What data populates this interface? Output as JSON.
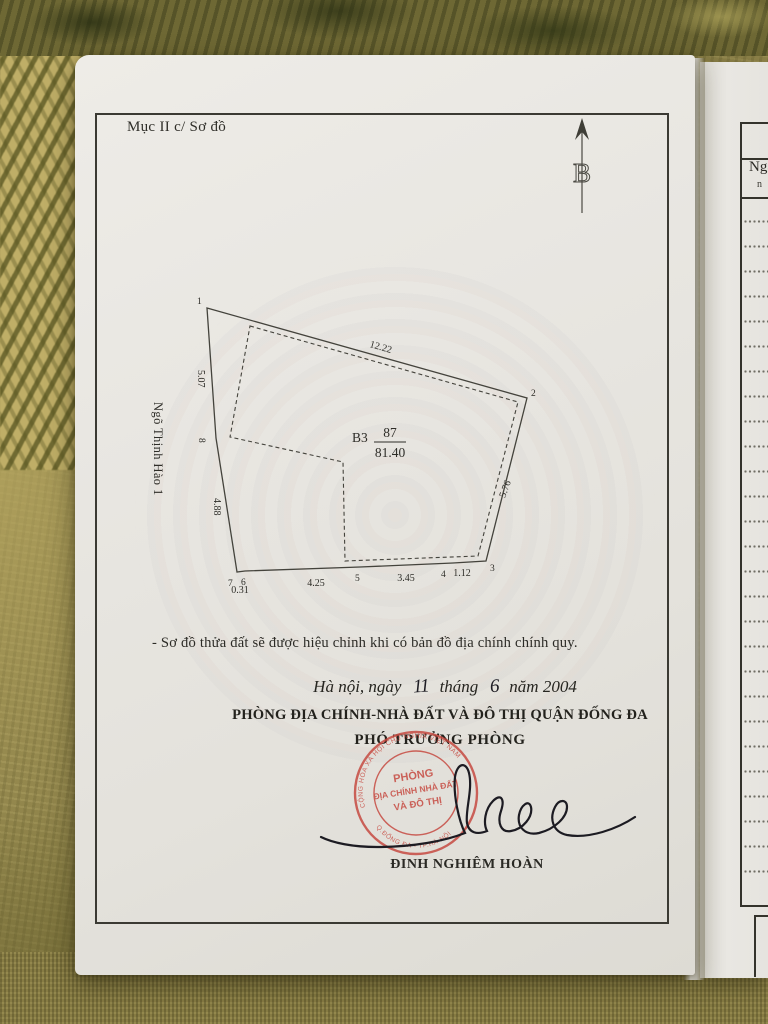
{
  "document": {
    "section_label": "Mục II c/ Sơ đồ",
    "compass_letter": "B",
    "note": "- Sơ đồ thửa đất sẽ được hiệu chỉnh khi có bản đồ địa chính chính quy.",
    "dateline": {
      "place_prefix": "Hà nội, ngày",
      "day_handwritten": "11",
      "month_word": "tháng",
      "month_handwritten": "6",
      "year_word": "năm",
      "year": "2004"
    },
    "office_name": "PHÒNG ĐỊA CHÍNH-NHÀ ĐẤT VÀ ĐÔ THỊ QUẬN ĐỐNG ĐA",
    "signer_title": "PHÓ TRƯỞNG PHÒNG",
    "signer_name": "ĐINH NGHIÊM HOÀN",
    "stamp": {
      "ring_top_text": "CỘNG HÒA XÃ HỘI CHỦ NGHĨA VIỆT NAM",
      "ring_bottom_text": "Q.ĐỐNG ĐA - TP.HÀ NỘI",
      "center_line1": "PHÒNG",
      "center_line2": "ĐỊA CHÍNH NHÀ ĐẤT",
      "center_line3": "VÀ ĐÔ THỊ",
      "color": "#c5453c"
    }
  },
  "diagram": {
    "street_name": "Ngõ Thịnh Hào 1",
    "parcel_label": "B3",
    "lot_number": "87",
    "area": "81.40",
    "point_labels": [
      "1",
      "2",
      "3",
      "4",
      "5",
      "6",
      "7",
      "8"
    ],
    "edge_lengths": {
      "top": "12.22",
      "left_upper": "5.07",
      "left_lower": "4.88",
      "right": "5.76",
      "bottom_segments": [
        "0.31",
        "4.25",
        "3.45",
        "1.12"
      ]
    }
  },
  "adjacent_page": {
    "column_header": "Ngà",
    "column_subheader": "n"
  }
}
